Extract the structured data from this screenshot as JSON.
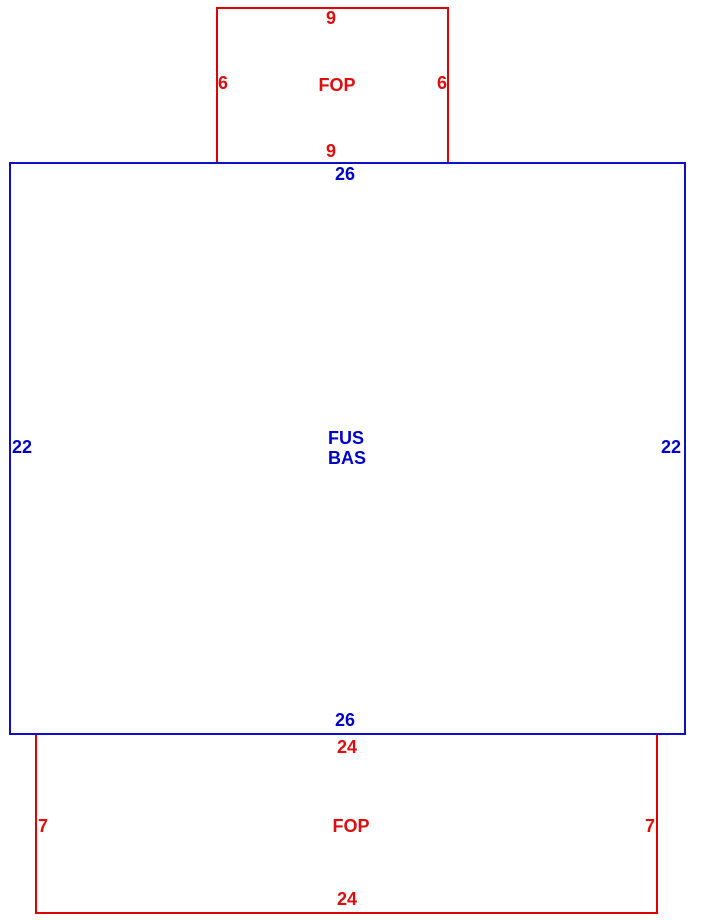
{
  "diagram": {
    "type": "building-area-sketch",
    "colors": {
      "red_outline": "#e00000",
      "blue_outline": "#0f0fc8",
      "red_text": "#dd0e0e",
      "blue_text": "#0000cc",
      "background": "#ffffff"
    },
    "shapes": [
      {
        "id": "fop-top",
        "label": "FOP",
        "color": "red",
        "dimensions": {
          "top": "9",
          "left": "6",
          "right": "6",
          "bottom": "9"
        }
      },
      {
        "id": "fus-bas",
        "label_lines": [
          "FUS",
          "BAS"
        ],
        "color": "blue",
        "dimensions": {
          "top": "26",
          "left": "22",
          "right": "22",
          "bottom": "26"
        }
      },
      {
        "id": "fop-bottom",
        "label": "FOP",
        "color": "red",
        "dimensions": {
          "top": "24",
          "left": "7",
          "right": "7",
          "bottom": "24"
        }
      }
    ]
  }
}
